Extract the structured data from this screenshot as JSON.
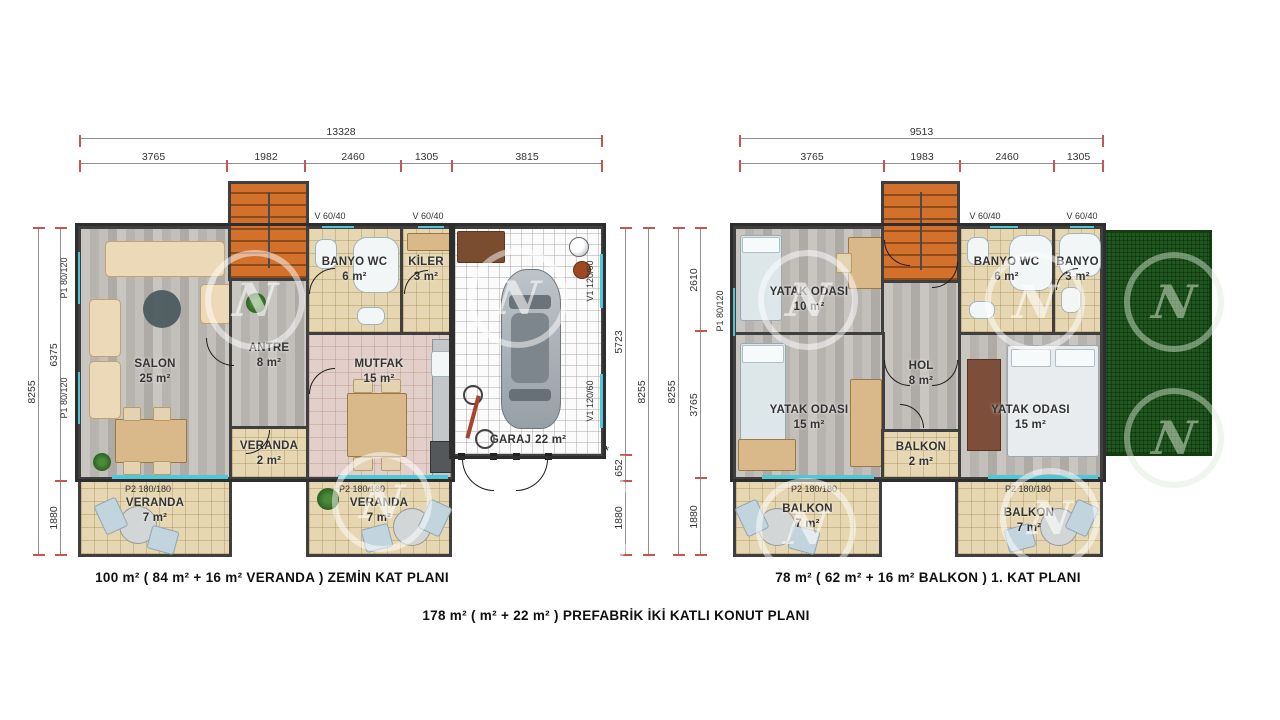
{
  "captions": {
    "ground_floor": "100 m²  ( 84 m² + 16 m²  VERANDA ) ZEMİN KAT  PLANI",
    "first_floor": "78 m² ( 62 m² + 16 m² BALKON ) 1. KAT  PLANI",
    "overall": "178  m²  (  m² + 22 m² )  PREFABRİK İKİ KATLI KONUT PLANI"
  },
  "watermark_letter": "N",
  "colors": {
    "stair_orange": "#d2702c",
    "roof_green": "#20591f",
    "window_cyan": "#4fc7d6",
    "dim_tick_red": "#c4574e",
    "wall_dark": "#3f3f3f"
  },
  "left_plan": {
    "dims": {
      "top_total": "13328",
      "top_segments": [
        "3765",
        "1982",
        "2460",
        "1305",
        "3815"
      ],
      "left_outer": "8255",
      "left_segments": [
        "6375",
        "1880"
      ],
      "right_segments": [
        "5723",
        "652",
        "1880"
      ],
      "right_outer": "8255"
    },
    "asterisk": "*",
    "openings": {
      "p1": "P1 80/120",
      "v": "V 60/40",
      "v1": "V1 120/60",
      "p2": "P2 180/180"
    },
    "rooms": {
      "salon": {
        "name": "SALON",
        "area": "25 m²"
      },
      "antre": {
        "name": "ANTRE",
        "area": "8 m²"
      },
      "banyo_wc": {
        "name": "BANYO WC",
        "area": "6 m²"
      },
      "kiler": {
        "name": "KİLER",
        "area": "3 m²"
      },
      "mutfak": {
        "name": "MUTFAK",
        "area": "15 m²"
      },
      "veranda_on": {
        "name": "VERANDA",
        "area": "2 m²"
      },
      "garaj": {
        "name": "GARAJ",
        "area": "22 m²"
      },
      "veranda_sol": {
        "name": "VERANDA",
        "area": "7 m²"
      },
      "veranda_sag": {
        "name": "VERANDA",
        "area": "7 m²"
      }
    }
  },
  "right_plan": {
    "dims": {
      "top_total": "9513",
      "top_segments": [
        "3765",
        "1983",
        "2460",
        "1305"
      ],
      "left_outer": "8255",
      "left_segments": [
        "2610",
        "3765",
        "1880"
      ]
    },
    "openings": {
      "p1": "P1 80/120",
      "v": "V 60/40",
      "p2": "P2 180/180"
    },
    "rooms": {
      "yatak_10": {
        "name": "YATAK ODASI",
        "area": "10 m²"
      },
      "banyo_wc": {
        "name": "BANYO WC",
        "area": "6 m²"
      },
      "banyo": {
        "name": "BANYO",
        "area": "3 m²"
      },
      "hol": {
        "name": "HOL",
        "area": "8 m²"
      },
      "yatak_15_sol": {
        "name": "YATAK ODASI",
        "area": "15 m²"
      },
      "yatak_15_sag": {
        "name": "YATAK ODASI",
        "area": "15 m²"
      },
      "balkon_on": {
        "name": "BALKON",
        "area": "2 m²"
      },
      "balkon_sol": {
        "name": "BALKON",
        "area": "7 m²"
      },
      "balkon_sag": {
        "name": "BALKON",
        "area": "7 m²"
      }
    }
  }
}
